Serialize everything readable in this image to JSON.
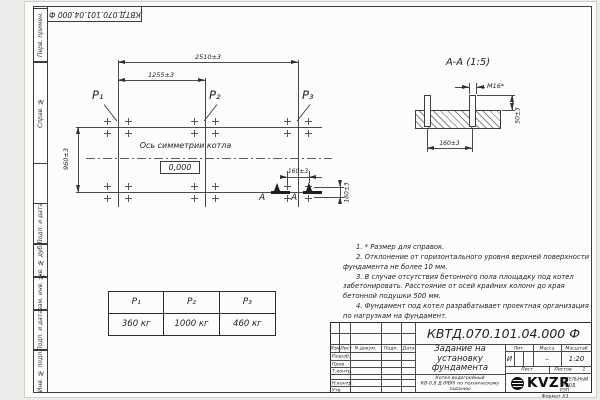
{
  "stamp": {
    "doc_number_top": "КВТД.070.101.04.000 Ф"
  },
  "frame_labels": [
    "Перв. примен.",
    "Справ. №",
    "Подп. и дата",
    "Инв. № дубл.",
    "Взам. инв. №",
    "Подп. и дата",
    "Инв. № подл."
  ],
  "plan": {
    "dims": {
      "overall": "2510±3",
      "half": "1255±3",
      "depth": "960±3",
      "bolt_h": "160±3",
      "bolt_v": "160±3"
    },
    "labels": {
      "p1": "Р₁",
      "p2": "Р₂",
      "p3": "Р₃"
    },
    "axis_text": "Ось симметрии котла",
    "level_mark": "0,000",
    "section_letter": "А"
  },
  "section": {
    "title": "А-А (1:5)",
    "thread": "М16*",
    "dim_width": "160±3",
    "dim_height": "50±3"
  },
  "load_table": {
    "headers": [
      "Р₁",
      "Р₂",
      "Р₃"
    ],
    "values": [
      "360 кг",
      "1000 кг",
      "460 кг"
    ]
  },
  "notes": [
    "1. * Размер для справок.",
    "2. Отклонение от горизонтального уровня верхней поверхности фундамента не более 10 мм.",
    "3. В случае отсутствия бетонного пола площадку под котел забетонировать. Расстояние от осей крайних колонн до края бетонной подушки 500 мм.",
    "4. Фундамент под котел разрабатывает проектная организация по нагрузкам на фундамент."
  ],
  "title_block": {
    "doc_number": "КВТД.070.101.04.000 Ф",
    "title": "Задание на\nустановку\nфундамента",
    "product": "Котел водогрейный\nКВ-0,8 Д (РВР) по техническому\nзаданию",
    "header_cols": [
      "Изм.",
      "Лист",
      "N докум.",
      "Подп.",
      "Дата"
    ],
    "sign_rows": [
      "Разраб.",
      "Пров.",
      "Т.контр.",
      "Н.контр.",
      "Утв."
    ],
    "lit_label": "Лит.",
    "mass_label": "Масса",
    "scale_label": "Масштаб",
    "lit": "И",
    "mass": "–",
    "scale": "1:20",
    "sheet_label": "Лист",
    "sheets_label": "Листов",
    "sheets": "1",
    "logo_text": "KVZR",
    "logo_caption": "КОТЕЛЬНЫЙ\nЗАВОД РЭП",
    "format": "Формат А3"
  }
}
